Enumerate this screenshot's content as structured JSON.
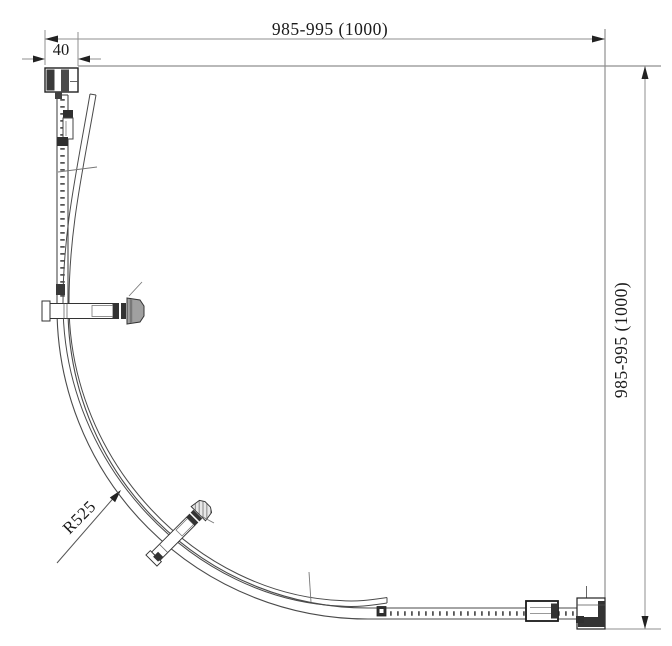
{
  "drawing": {
    "dimensions": {
      "top_width": "985-995 (1000)",
      "profile_width": "40",
      "right_height": "985-995 (1000)",
      "radius": "R525"
    },
    "colors": {
      "background": "#ffffff",
      "structure_line": "#4a4a4a",
      "dimension_line": "#8f8f8f",
      "text": "#1a1a1a",
      "dark_fill": "#333333",
      "knob_gray": "#a0a0a0"
    }
  }
}
